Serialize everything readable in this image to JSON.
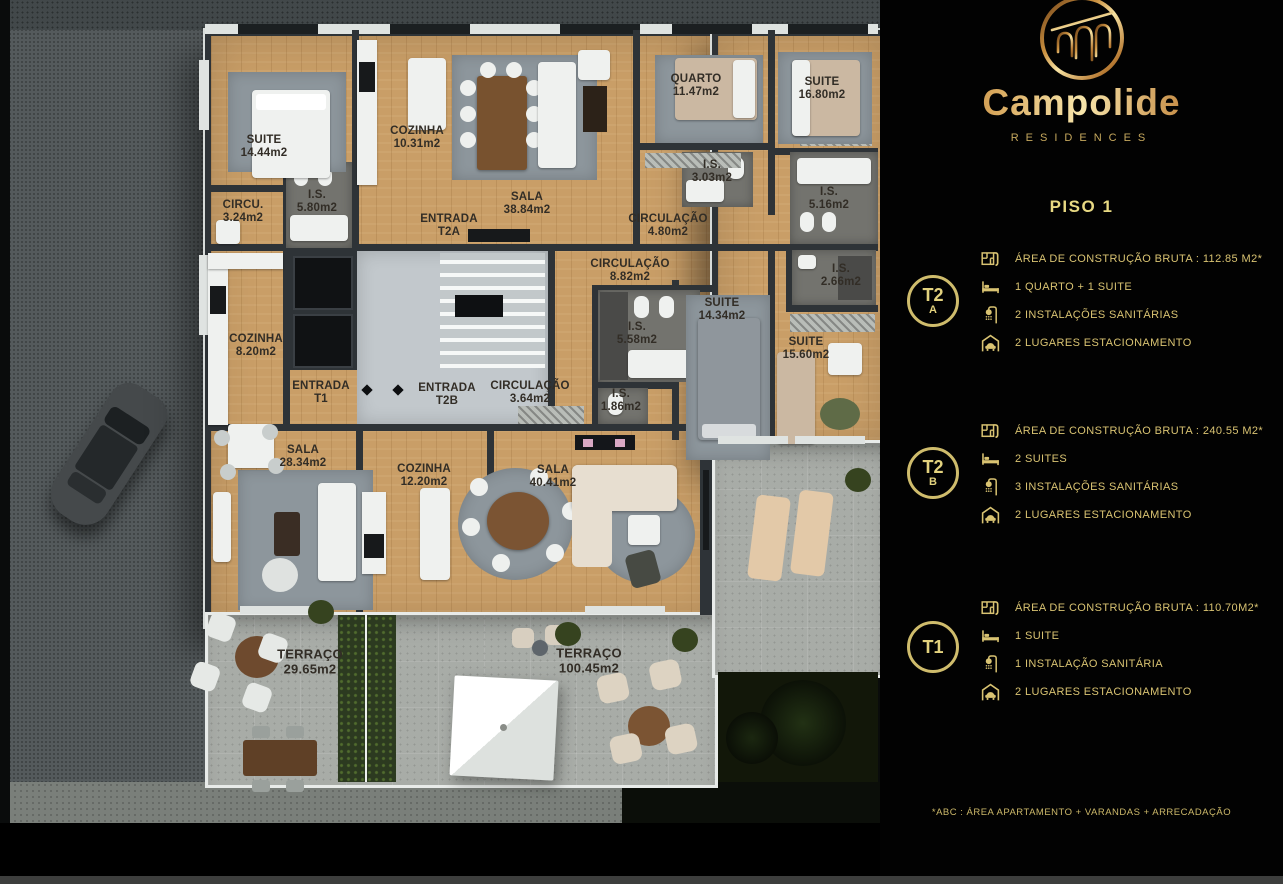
{
  "brand": {
    "name": "Campolide",
    "tagline": "RESIDENCES"
  },
  "floor": {
    "title": "PISO 1"
  },
  "footnote": "*ABC :  ÁREA APARTAMENTO + VARANDAS + ARRECADAÇÃO",
  "colors": {
    "gold": "#d9c372",
    "gold_bright": "#f7e5ab",
    "wood": "#c99e67",
    "wall": "#2e3337",
    "terrace": "#a8aca7"
  },
  "panel": {
    "units": [
      {
        "id": "T2A",
        "badge_main": "T2",
        "badge_sub": "A",
        "specs": [
          {
            "icon": "floorplan-icon",
            "text": "ÁREA DE CONSTRUÇÃO BRUTA :  112.85 M2*"
          },
          {
            "icon": "bed-icon",
            "text": "1 QUARTO + 1 SUITE"
          },
          {
            "icon": "shower-icon",
            "text": "2 INSTALAÇÕES SANITÁRIAS"
          },
          {
            "icon": "garage-icon",
            "text": "2 LUGARES ESTACIONAMENTO"
          }
        ]
      },
      {
        "id": "T2B",
        "badge_main": "T2",
        "badge_sub": "B",
        "specs": [
          {
            "icon": "floorplan-icon",
            "text": "ÁREA DE CONSTRUÇÃO BRUTA :  240.55 M2*"
          },
          {
            "icon": "bed-icon",
            "text": "2 SUITES"
          },
          {
            "icon": "shower-icon",
            "text": "3 INSTALAÇÕES SANITÁRIAS"
          },
          {
            "icon": "garage-icon",
            "text": "2 LUGARES ESTACIONAMENTO"
          }
        ]
      },
      {
        "id": "T1",
        "badge_main": "T1",
        "badge_sub": "",
        "specs": [
          {
            "icon": "floorplan-icon",
            "text": "ÁREA DE CONSTRUÇÃO BRUTA :  110.70M2*"
          },
          {
            "icon": "bed-icon",
            "text": "1 SUITE"
          },
          {
            "icon": "shower-icon",
            "text": "1 INSTALAÇÃO SANITÁRIA"
          },
          {
            "icon": "garage-icon",
            "text": "2 LUGARES ESTACIONAMENTO"
          }
        ]
      }
    ]
  },
  "plan": {
    "rooms": [
      {
        "name": "SUITE",
        "area": "14.44m2"
      },
      {
        "name": "COZINHA",
        "area": "10.31m2"
      },
      {
        "name": "CIRCU.",
        "area": "3.24m2"
      },
      {
        "name": "I.S.",
        "area": "5.80m2"
      },
      {
        "name": "SALA",
        "area": "38.84m2"
      },
      {
        "name": "ENTRADA",
        "area": "T2A"
      },
      {
        "name": "CIRCULAÇÃO",
        "area": "4.80m2"
      },
      {
        "name": "QUARTO",
        "area": "11.47m2"
      },
      {
        "name": "I.S.",
        "area": "3.03m2"
      },
      {
        "name": "SUITE",
        "area": "16.80m2"
      },
      {
        "name": "I.S.",
        "area": "5.16m2"
      },
      {
        "name": "COZINHA",
        "area": "8.20m2"
      },
      {
        "name": "ENTRADA",
        "area": "T1"
      },
      {
        "name": "ENTRADA",
        "area": "T2B"
      },
      {
        "name": "CIRCULAÇÃO",
        "area": "3.64m2"
      },
      {
        "name": "CIRCULAÇÃO",
        "area": "8.82m2"
      },
      {
        "name": "I.S.",
        "area": "5.58m2"
      },
      {
        "name": "I.S.",
        "area": "1.86m2"
      },
      {
        "name": "SUITE",
        "area": "14.34m2"
      },
      {
        "name": "SUITE",
        "area": "15.60m2"
      },
      {
        "name": "I.S.",
        "area": "2.66m2"
      },
      {
        "name": "SALA",
        "area": "28.34m2"
      },
      {
        "name": "COZINHA",
        "area": "12.20m2"
      },
      {
        "name": "SALA",
        "area": "40.41m2"
      },
      {
        "name": "TERRAÇO",
        "area": "29.65m2"
      },
      {
        "name": "TERRAÇO",
        "area": "100.45m2"
      }
    ]
  }
}
